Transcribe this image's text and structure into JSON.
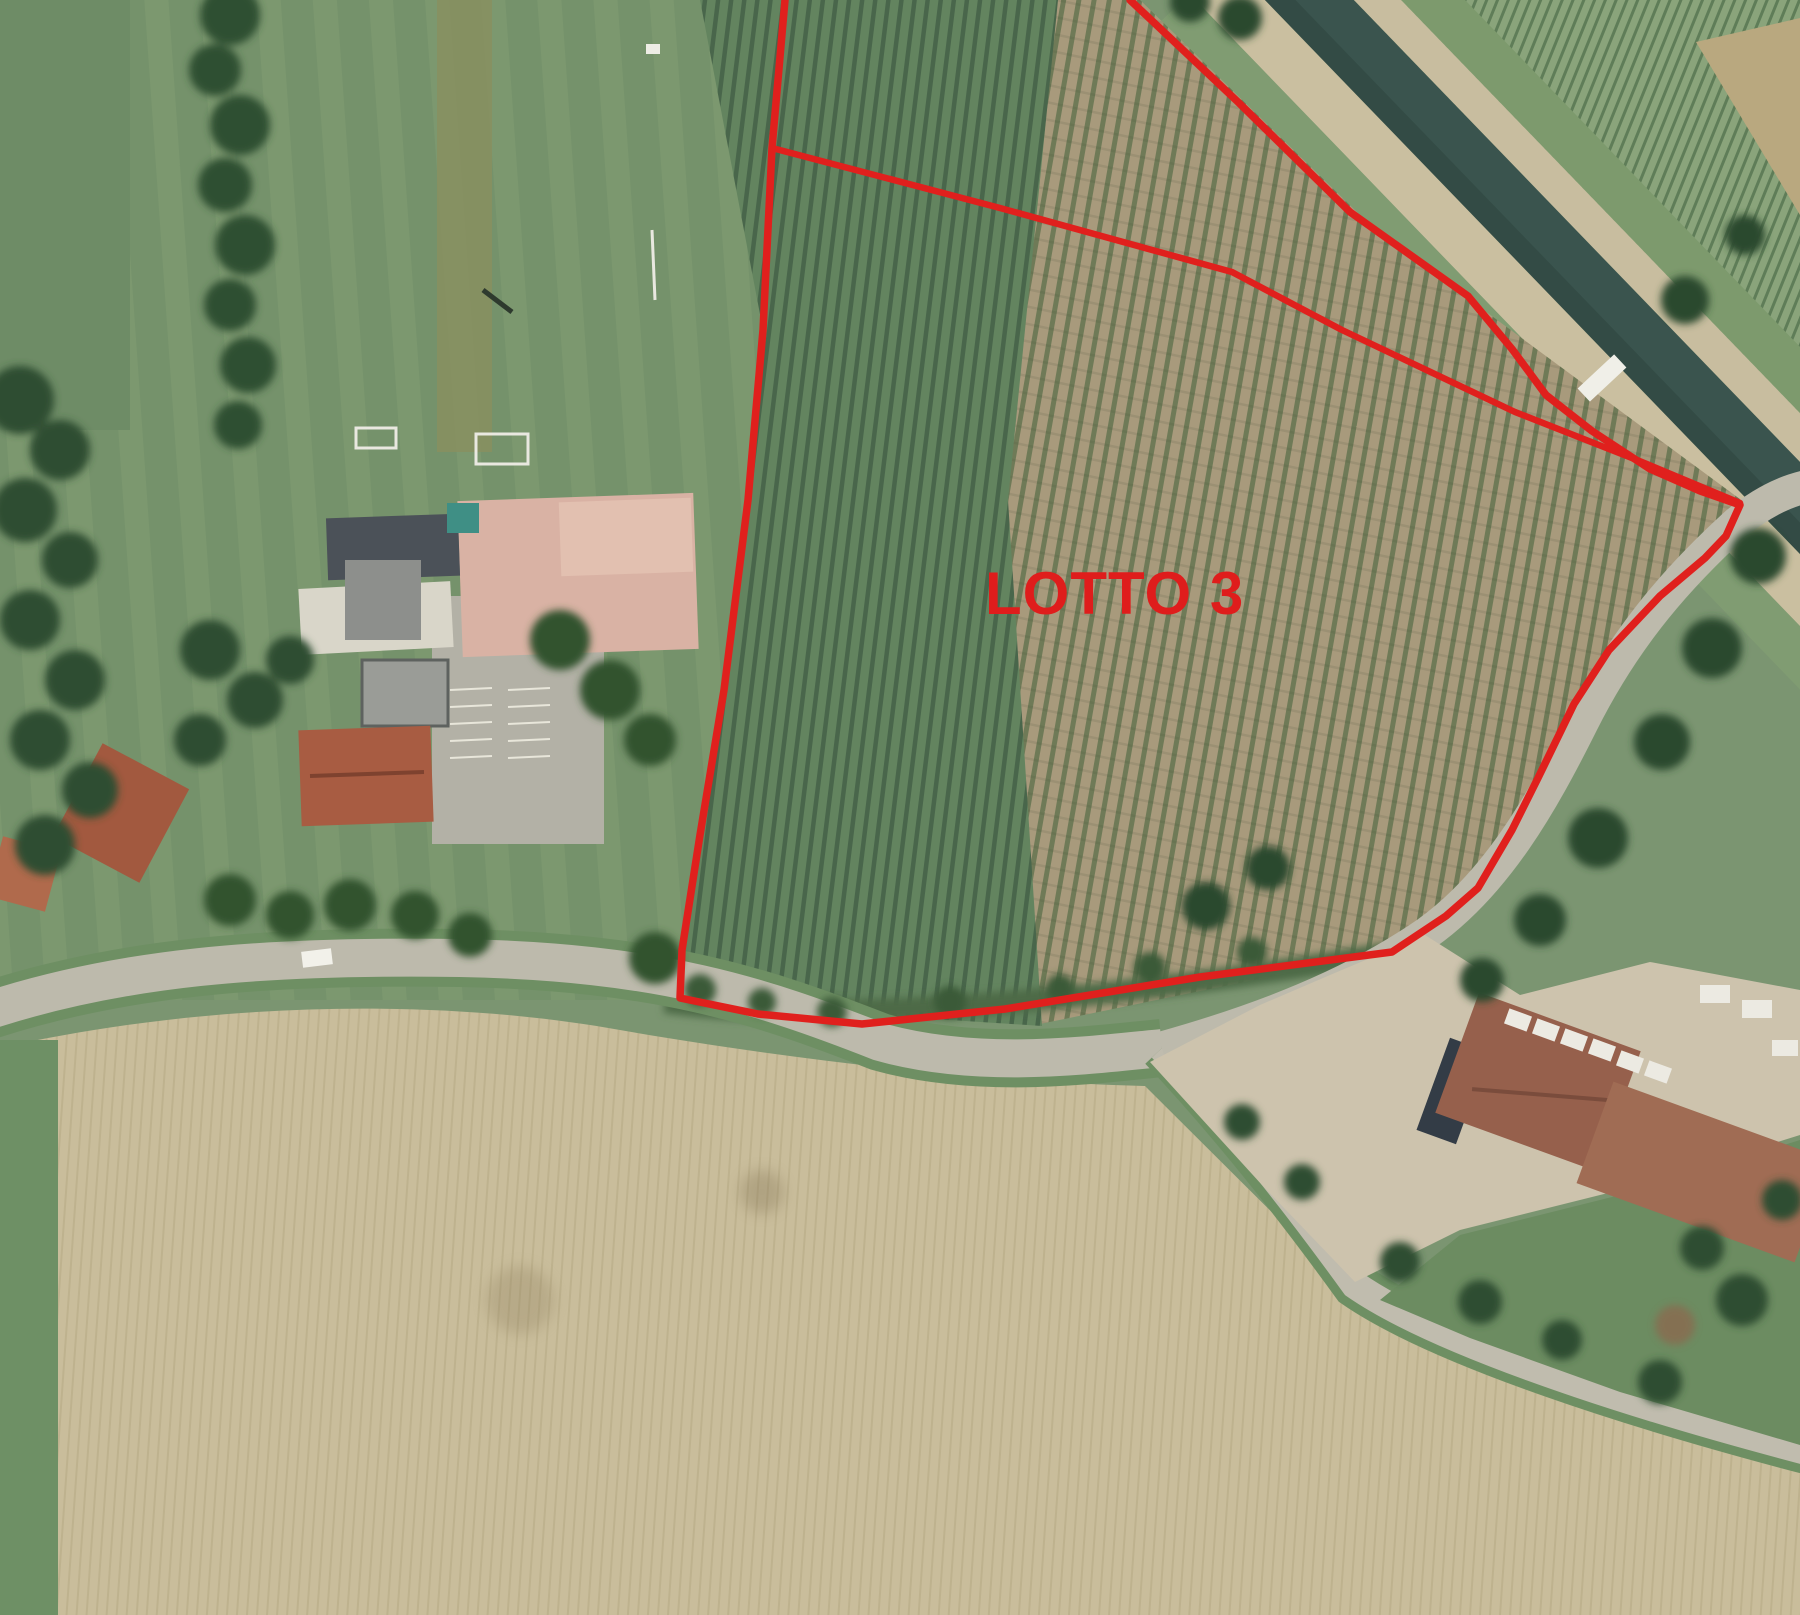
{
  "overlay": {
    "parcel_label": "LOTTO 3",
    "boundary_color": "#e0201d",
    "label_color": "#df1d1c",
    "outer_boundary_points": "785,0 772,148 763,330 748,500 724,690 700,835 682,950 680,998 758,1014 862,1024 1005,1009 1200,977 1392,952 1446,916 1478,888 1512,830 1538,778 1574,704 1609,650 1660,596 1705,558 1726,536 1740,505 1700,491 1650,469 1592,431 1546,395 1512,349 1468,296 1350,212 1238,102 1130,0",
    "division_line_points": "772,148 1000,208 1232,272 1342,330 1515,412 1642,462 1740,503"
  },
  "scene": {
    "description": "aerial orthophoto of farmland parcel outlined in red",
    "features": [
      "sports field with goals",
      "farm buildings with pink and terracotta roofs",
      "striped parking area",
      "green vineyard rows inside parcel",
      "tan orchard rows inside parcel",
      "irrigation canal with side paths",
      "row-crop field beyond canal",
      "country road junction",
      "farmyard with brown barns and white trucks",
      "plowed tan field",
      "tree lines and hedgerows"
    ],
    "colors": {
      "vineyard_green": "#63845f",
      "orchard_tan": "#a89a7c",
      "plowed_field_tan": "#c9bd9b",
      "grass_green": "#75926b",
      "road_gray": "#bdbaac",
      "canal_water": "#3a544e",
      "roof_pink": "#d9b2a4",
      "roof_terracotta": "#a85c42",
      "barn_brown": "#96604c",
      "tree_dark_green": "#2f4f31"
    }
  }
}
